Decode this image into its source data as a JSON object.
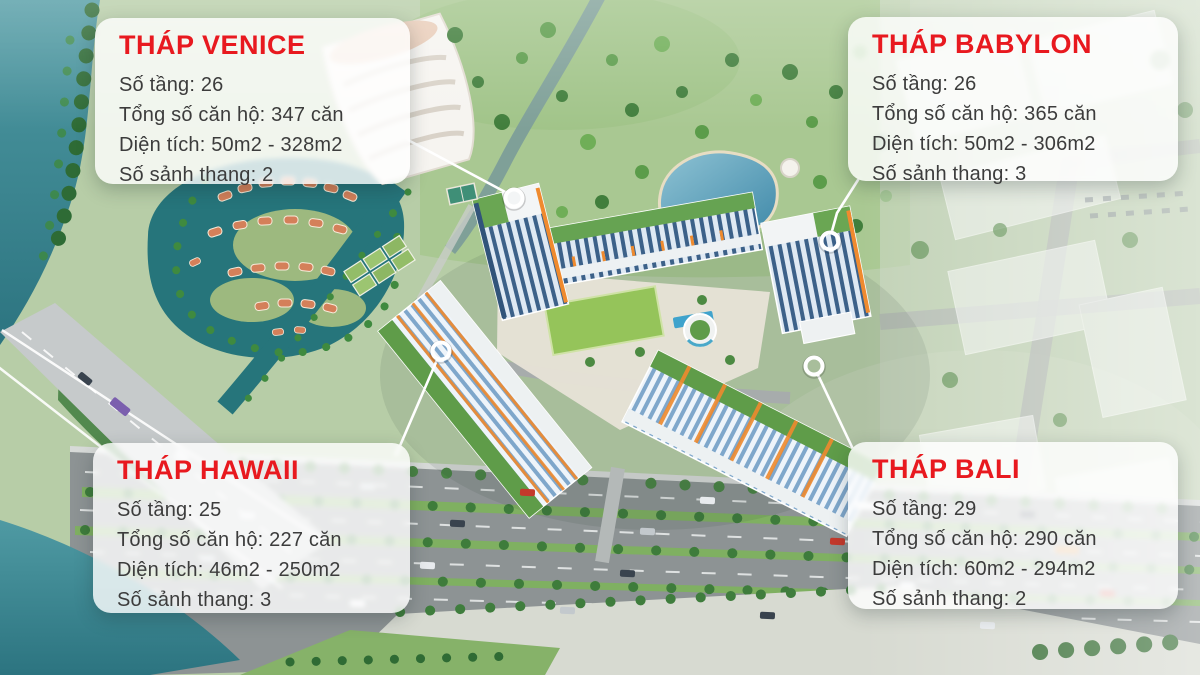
{
  "callouts": {
    "venice": {
      "title": "THÁP VENICE",
      "lines": [
        "Số tầng: 26",
        "Tổng số căn hộ: 347 căn",
        "Diện tích: 50m2 - 328m2",
        "Số sảnh thang: 2"
      ]
    },
    "babylon": {
      "title": "THÁP BABYLON",
      "lines": [
        "Số tầng: 26",
        "Tổng số căn hộ: 365 căn",
        "Diện tích: 50m2 - 306m2",
        "Số sảnh thang: 3"
      ]
    },
    "hawaii": {
      "title": "THÁP HAWAII",
      "lines": [
        "Số tầng: 25",
        "Tổng số căn hộ: 227 căn",
        "Diện tích: 46m2 - 250m2",
        "Số sảnh thang: 3"
      ]
    },
    "bali": {
      "title": "THÁP BALI",
      "lines": [
        "Số tầng: 29",
        "Tổng số căn hộ: 290 căn",
        "Diện tích: 60m2 - 294m2",
        "Số sảnh thang: 2"
      ]
    }
  },
  "colors": {
    "title_red": "#e8191f",
    "body_text": "#3c3c3c",
    "card_bg": "rgba(255,255,255,0.8)",
    "marker": "#ffffff",
    "water": "#2c7480",
    "accent_orange": "#ef8a2e",
    "facade_blue": "#3c6189",
    "roof_green": "#5f9c49"
  }
}
